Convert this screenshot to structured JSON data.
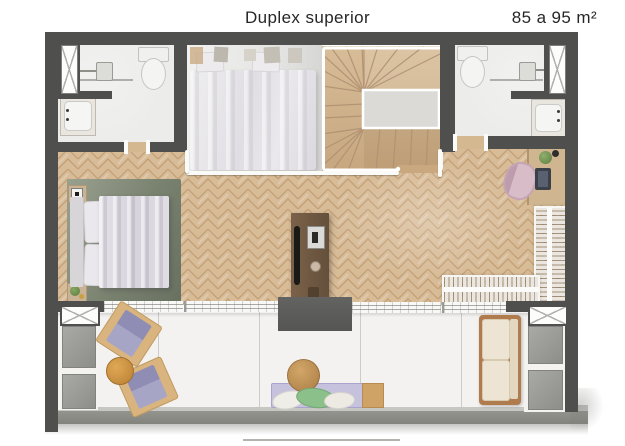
{
  "header": {
    "title": "Duplex superior",
    "area_range": "85 a 95 m²"
  },
  "palette": {
    "wall": "#4f4f4d",
    "wood-floor": "#d8bc98",
    "wood-line": "#c19e74",
    "stair-wood": "#d2b890",
    "marble": "#ececea",
    "balcony-floor": "#f3f2f0",
    "rug": "#7e8677",
    "lilac": "#9e9cc0",
    "green-pillow": "#8cc08a",
    "sofa-cream": "#eee4d3",
    "void-grey": "#5c5c5a",
    "rail-white": "#fafaf8"
  },
  "legend": [
    "bathroom",
    "shower",
    "toilet",
    "washbasin",
    "window",
    "bed",
    "rug",
    "nightstand",
    "staircase",
    "landing",
    "tv-panel",
    "fireplace",
    "desk",
    "desk-chair",
    "wardrobe",
    "sliding-doors",
    "void",
    "balcony",
    "lounge-chair",
    "side-table",
    "bench",
    "pillows",
    "sofa",
    "planter"
  ]
}
